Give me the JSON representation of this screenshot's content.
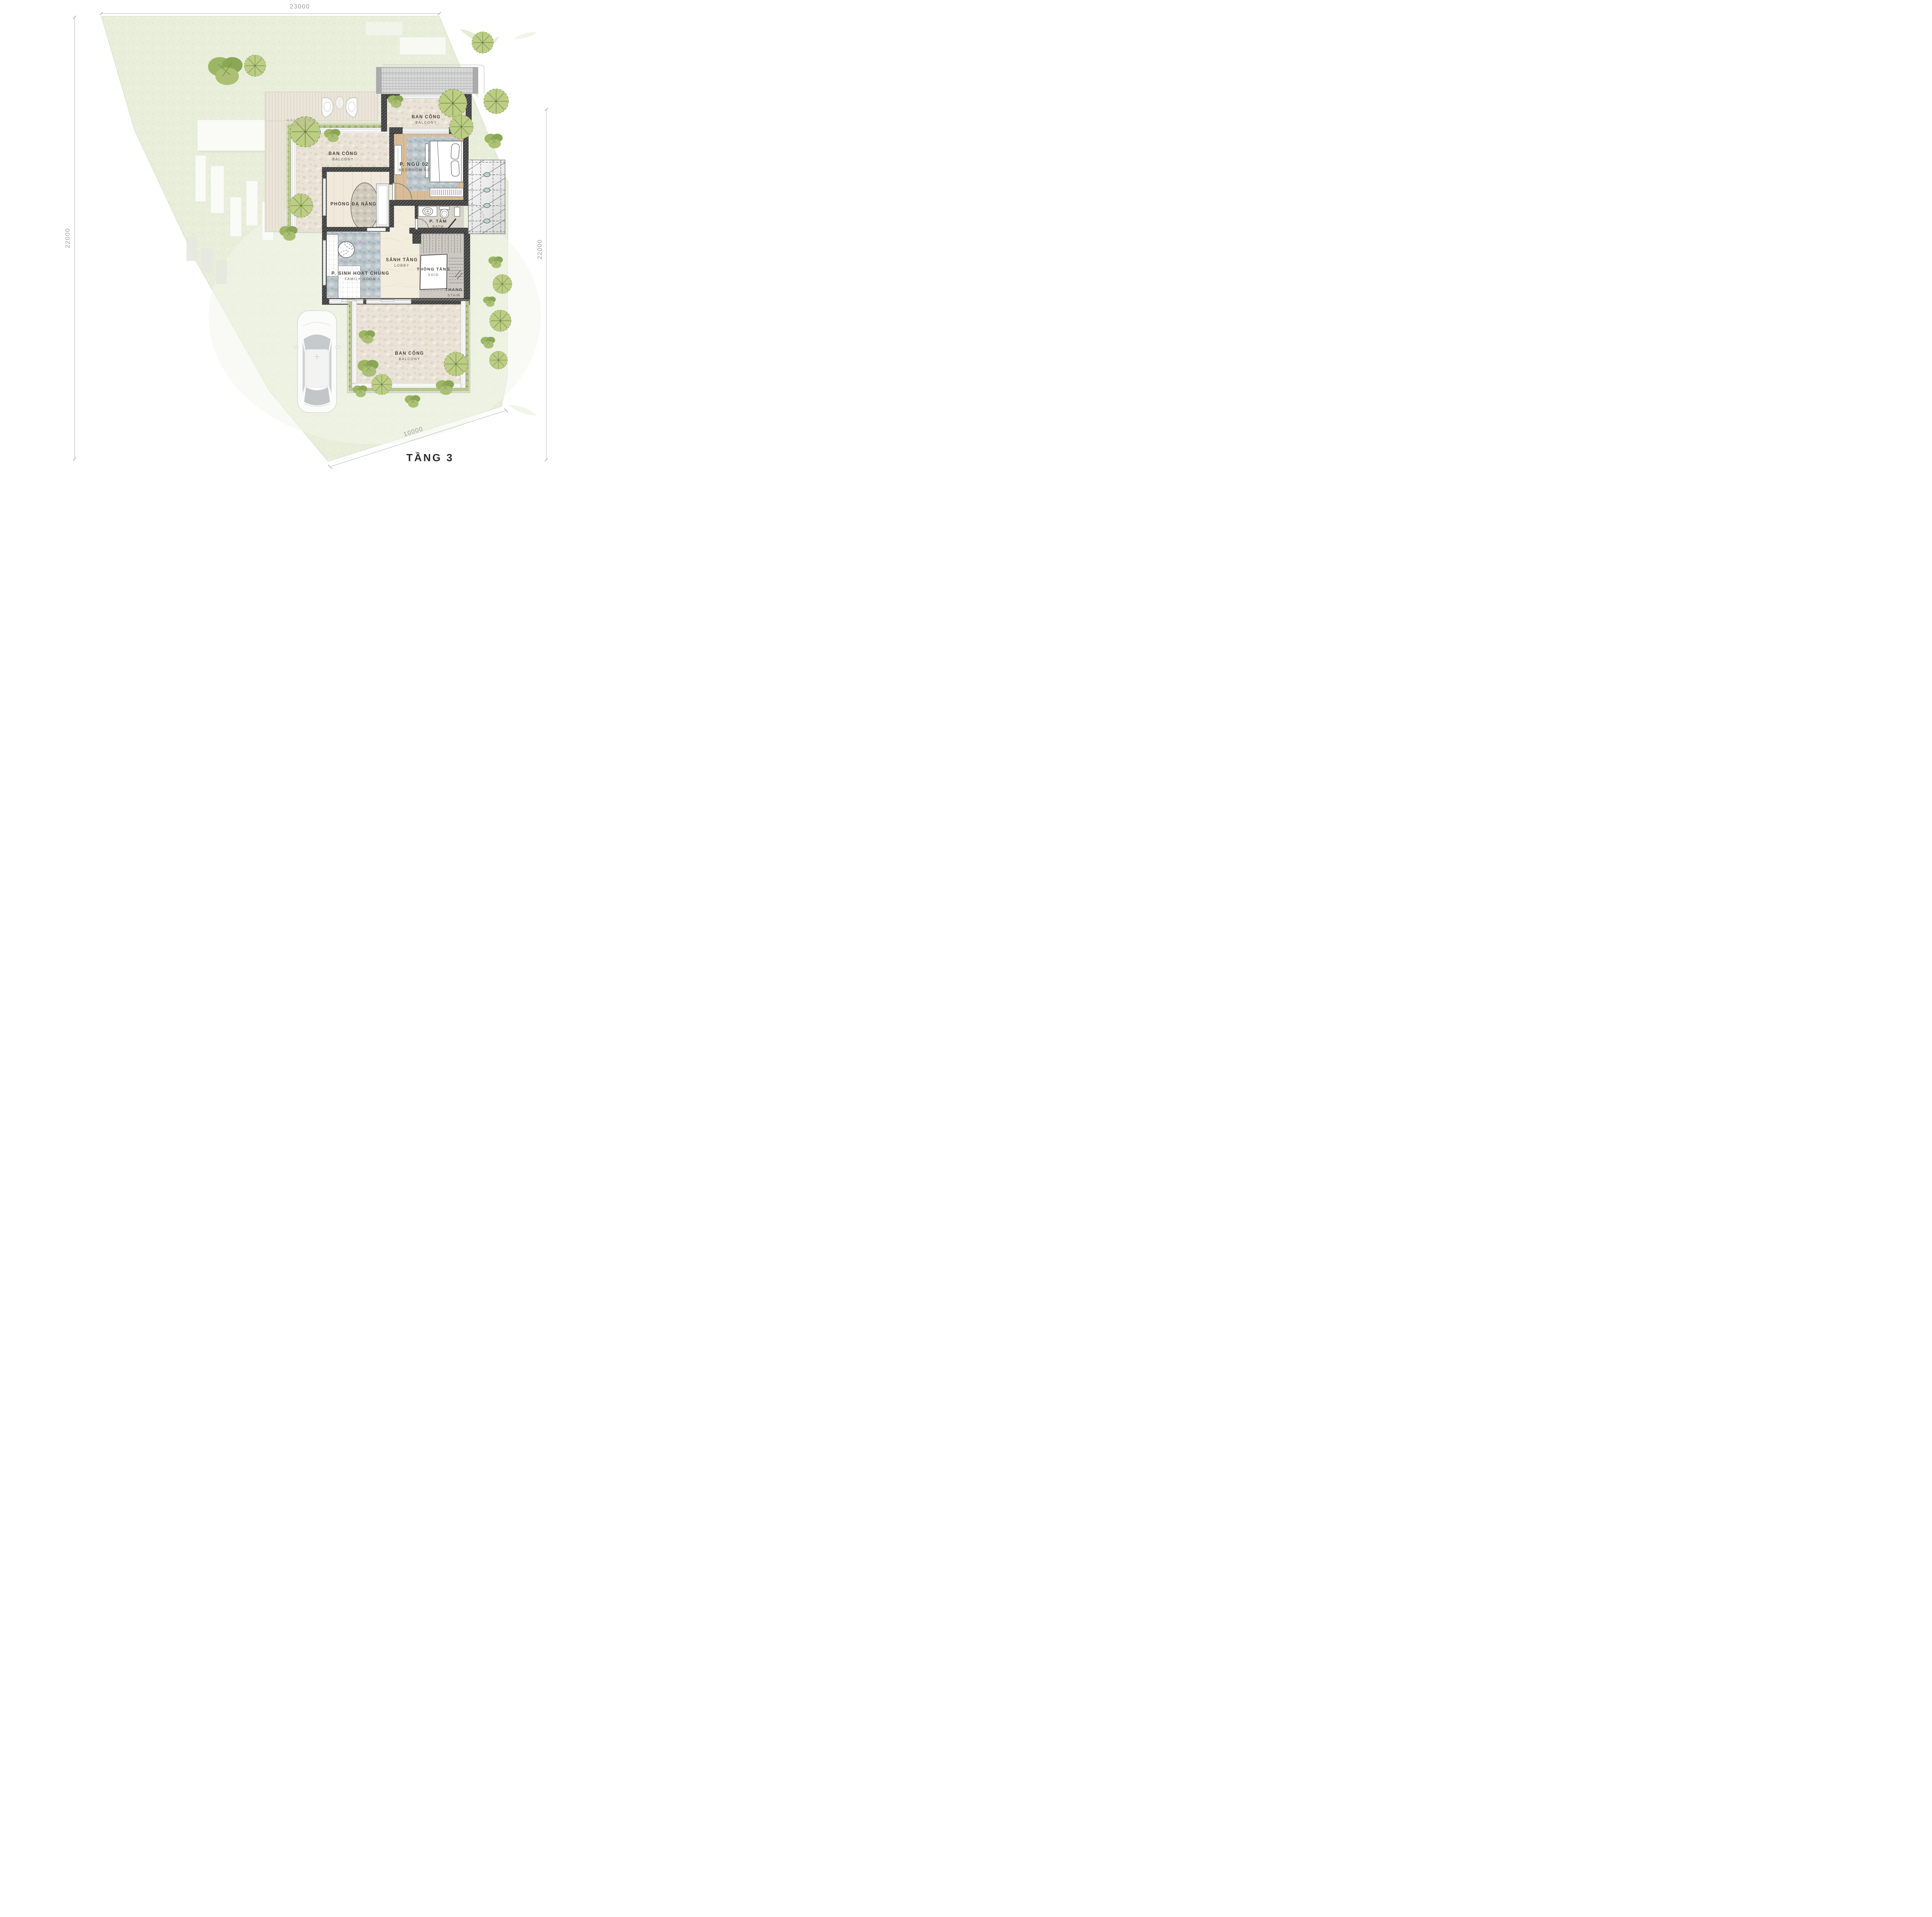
{
  "plan": {
    "title": "TẦNG 3"
  },
  "dimensions": {
    "top": "23000",
    "left": "22000",
    "right": "22000",
    "bottom": "10000"
  },
  "rooms": {
    "terrace": {
      "vi": "HÀNG HIÊN",
      "en": "TERRACE"
    },
    "balcony_left": {
      "vi": "BAN CÔNG",
      "en": "BALCONY"
    },
    "balcony_top": {
      "vi": "BAN CÔNG",
      "en": "BALCONY"
    },
    "balcony_bottom": {
      "vi": "BAN CÔNG",
      "en": "BALCONY"
    },
    "bedroom02": {
      "vi": "P. NGỦ 02",
      "en": "BEDROOM 02"
    },
    "multipurpose": {
      "vi": "PHÒNG ĐA NĂNG",
      "en": ""
    },
    "bath": {
      "vi": "P. TẮM",
      "en": "BATH"
    },
    "lobby": {
      "vi": "SẢNH TẦNG",
      "en": "LOBBY"
    },
    "void": {
      "vi": "THÔNG TẦNG",
      "en": "VOID"
    },
    "stair": {
      "vi": "THANG",
      "en": "STAIR"
    },
    "family": {
      "vi": "P. SINH HOẠT CHUNG",
      "en": "FAMILY ROOM"
    }
  },
  "colors": {
    "grass": "#e8eeda",
    "stone": "#eae3d7",
    "wood": "#d9bd9a",
    "wall": "#3e3e3e",
    "roof": "#d8d8d8",
    "lawn_strip": "#b9c88e",
    "tree_green": "#9cb763",
    "accent_teal": "#bad7ca",
    "dim_text": "#9c9c9c",
    "label_text": "#46413a"
  }
}
